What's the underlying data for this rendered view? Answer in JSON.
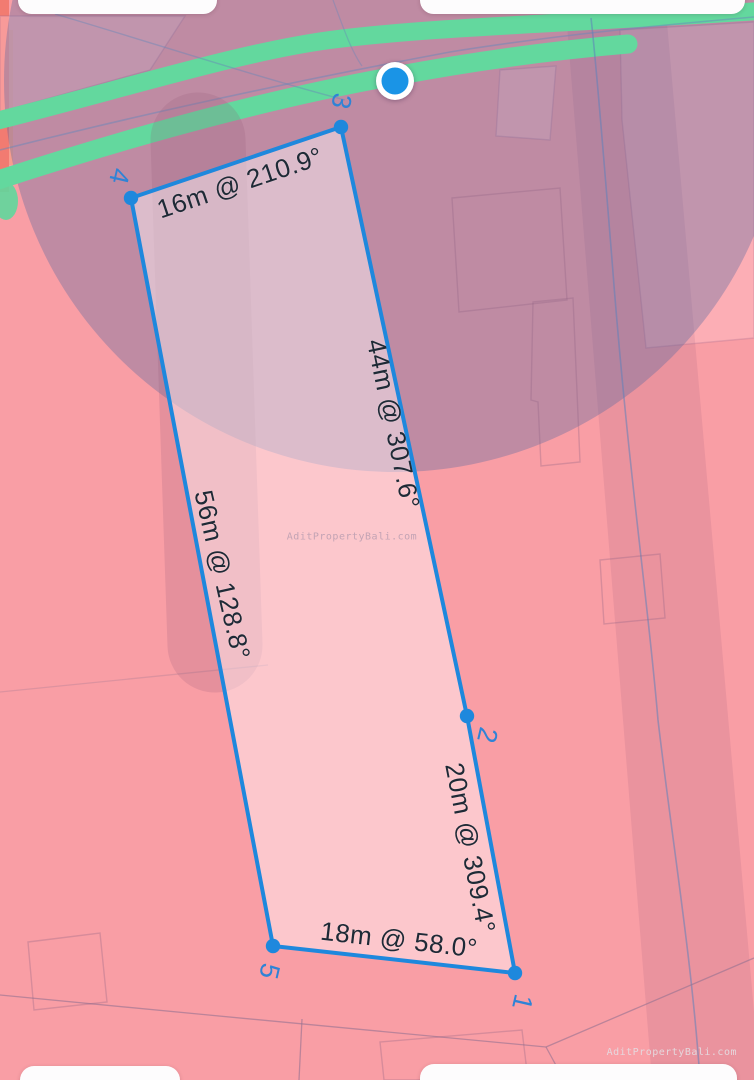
{
  "app": {
    "type": "land-measurement-map-view"
  },
  "plot": {
    "vertices": [
      {
        "id": "1"
      },
      {
        "id": "2"
      },
      {
        "id": "3"
      },
      {
        "id": "4"
      },
      {
        "id": "5"
      }
    ],
    "edges": [
      {
        "from": "4",
        "to": "3",
        "label": "16m @ 210.9°",
        "length_m": 16,
        "bearing_deg": 210.9
      },
      {
        "from": "3",
        "to": "2",
        "label": "44m @ 307.6°",
        "length_m": 44,
        "bearing_deg": 307.6
      },
      {
        "from": "4",
        "to": "5",
        "label": "56m @ 128.8°",
        "length_m": 56,
        "bearing_deg": 128.8
      },
      {
        "from": "2",
        "to": "1",
        "label": "20m @ 309.4°",
        "length_m": 20,
        "bearing_deg": 309.4
      },
      {
        "from": "5",
        "to": "1",
        "label": "18m @ 58.0°",
        "length_m": 18,
        "bearing_deg": 58.0
      }
    ]
  },
  "watermark": {
    "center": "AditPropertyBali.com",
    "bottom_right": "AditPropertyBali.com"
  },
  "colors": {
    "map_pink": "#f99ea5",
    "accent_blue": "#1e88dd",
    "vertex_label_blue": "#2f83d6",
    "road_green": "#63d89e",
    "accuracy_overlay": "#5a6aa0",
    "edge_label_dark": "#1e2a36",
    "location_dot_blue": "#1a94e6"
  }
}
